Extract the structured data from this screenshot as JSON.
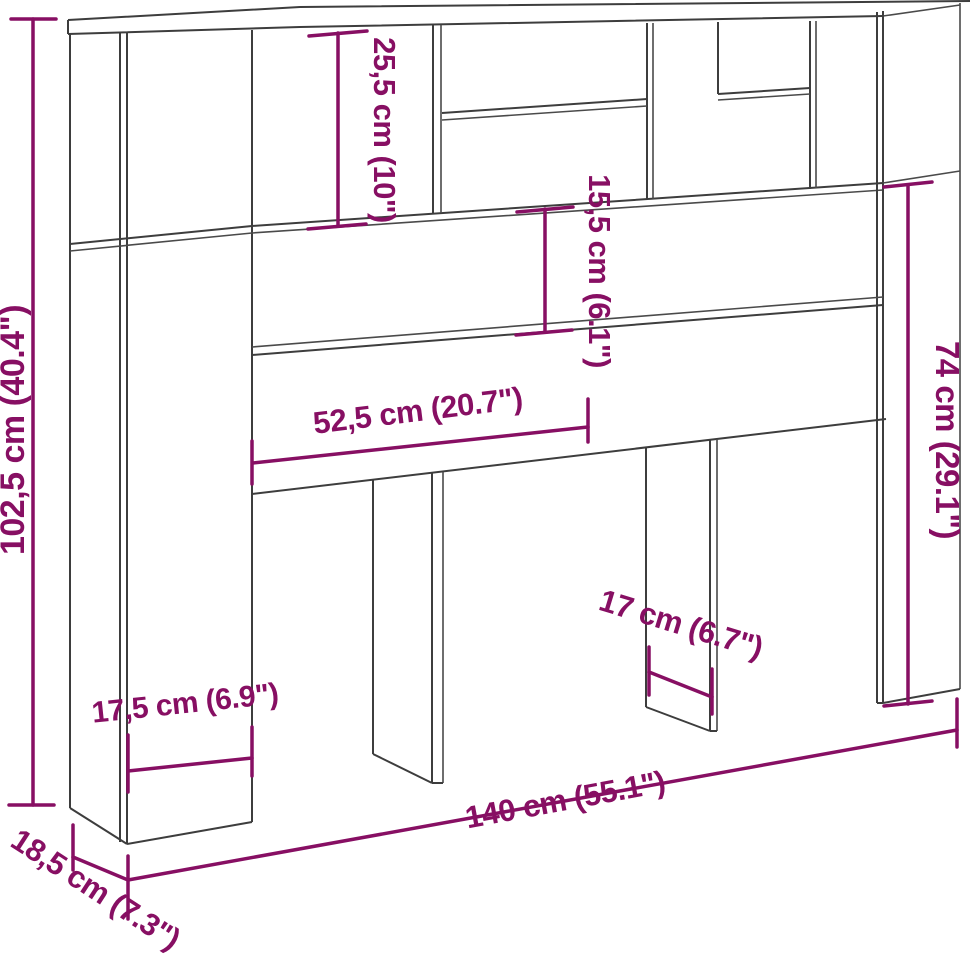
{
  "diagram": {
    "type": "furniture-dimension-drawing",
    "subject": "headboard cabinet with open storage shelves",
    "background_color": "#ffffff",
    "colors": {
      "outline": "#3d3d3d",
      "dimension": "#870f63"
    },
    "dimensions": [
      {
        "id": "total-height",
        "label": "102,5 cm (40.4\")",
        "value_cm": 102.5,
        "value_in": 40.4
      },
      {
        "id": "top-shelf-height",
        "label": "25,5 cm (10\")",
        "value_cm": 25.5,
        "value_in": 10
      },
      {
        "id": "panel-board-height",
        "label": "15,5 cm (6.1\")",
        "value_cm": 15.5,
        "value_in": 6.1
      },
      {
        "id": "lower-side-height",
        "label": "74 cm (29.1\")",
        "value_cm": 74,
        "value_in": 29.1
      },
      {
        "id": "shelf-span-width",
        "label": "52,5 cm (20.7\")",
        "value_cm": 52.5,
        "value_in": 20.7
      },
      {
        "id": "left-column-width",
        "label": "17,5 cm (6.9\")",
        "value_cm": 17.5,
        "value_in": 6.9
      },
      {
        "id": "foot-depth",
        "label": "17 cm (6.7\")",
        "value_cm": 17,
        "value_in": 6.7
      },
      {
        "id": "total-width",
        "label": "140 cm (55.1\")",
        "value_cm": 140,
        "value_in": 55.1
      },
      {
        "id": "total-depth",
        "label": "18,5 cm (7.3\")",
        "value_cm": 18.5,
        "value_in": 7.3
      }
    ]
  }
}
